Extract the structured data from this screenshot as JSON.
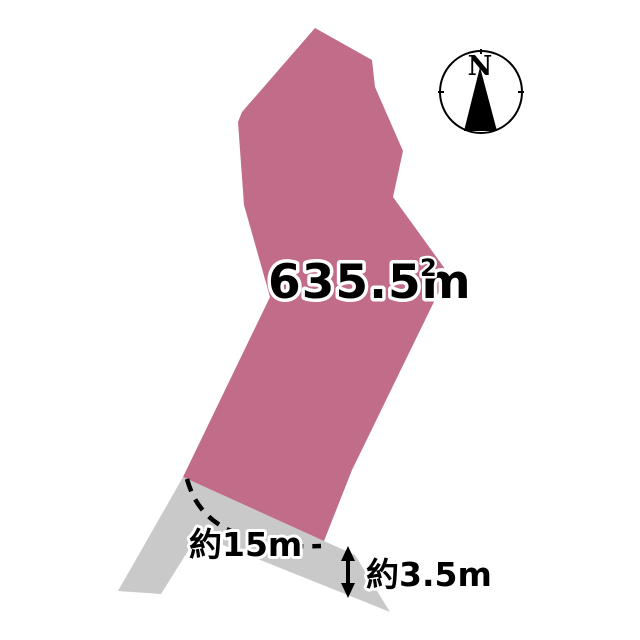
{
  "diagram": {
    "type": "land-plot-diagram",
    "plot": {
      "area_text": "635.5m",
      "area_exponent": "2"
    },
    "measurements": {
      "frontage_label": "約15m",
      "road_width_label": "約3.5m"
    },
    "compass": {
      "north_label": "N"
    },
    "colors": {
      "plot_fill": "#c16d89",
      "road_fill": "#c9c9c9",
      "line_color": "#000000",
      "text_outline": "#ffffff",
      "background": "#ffffff"
    }
  }
}
